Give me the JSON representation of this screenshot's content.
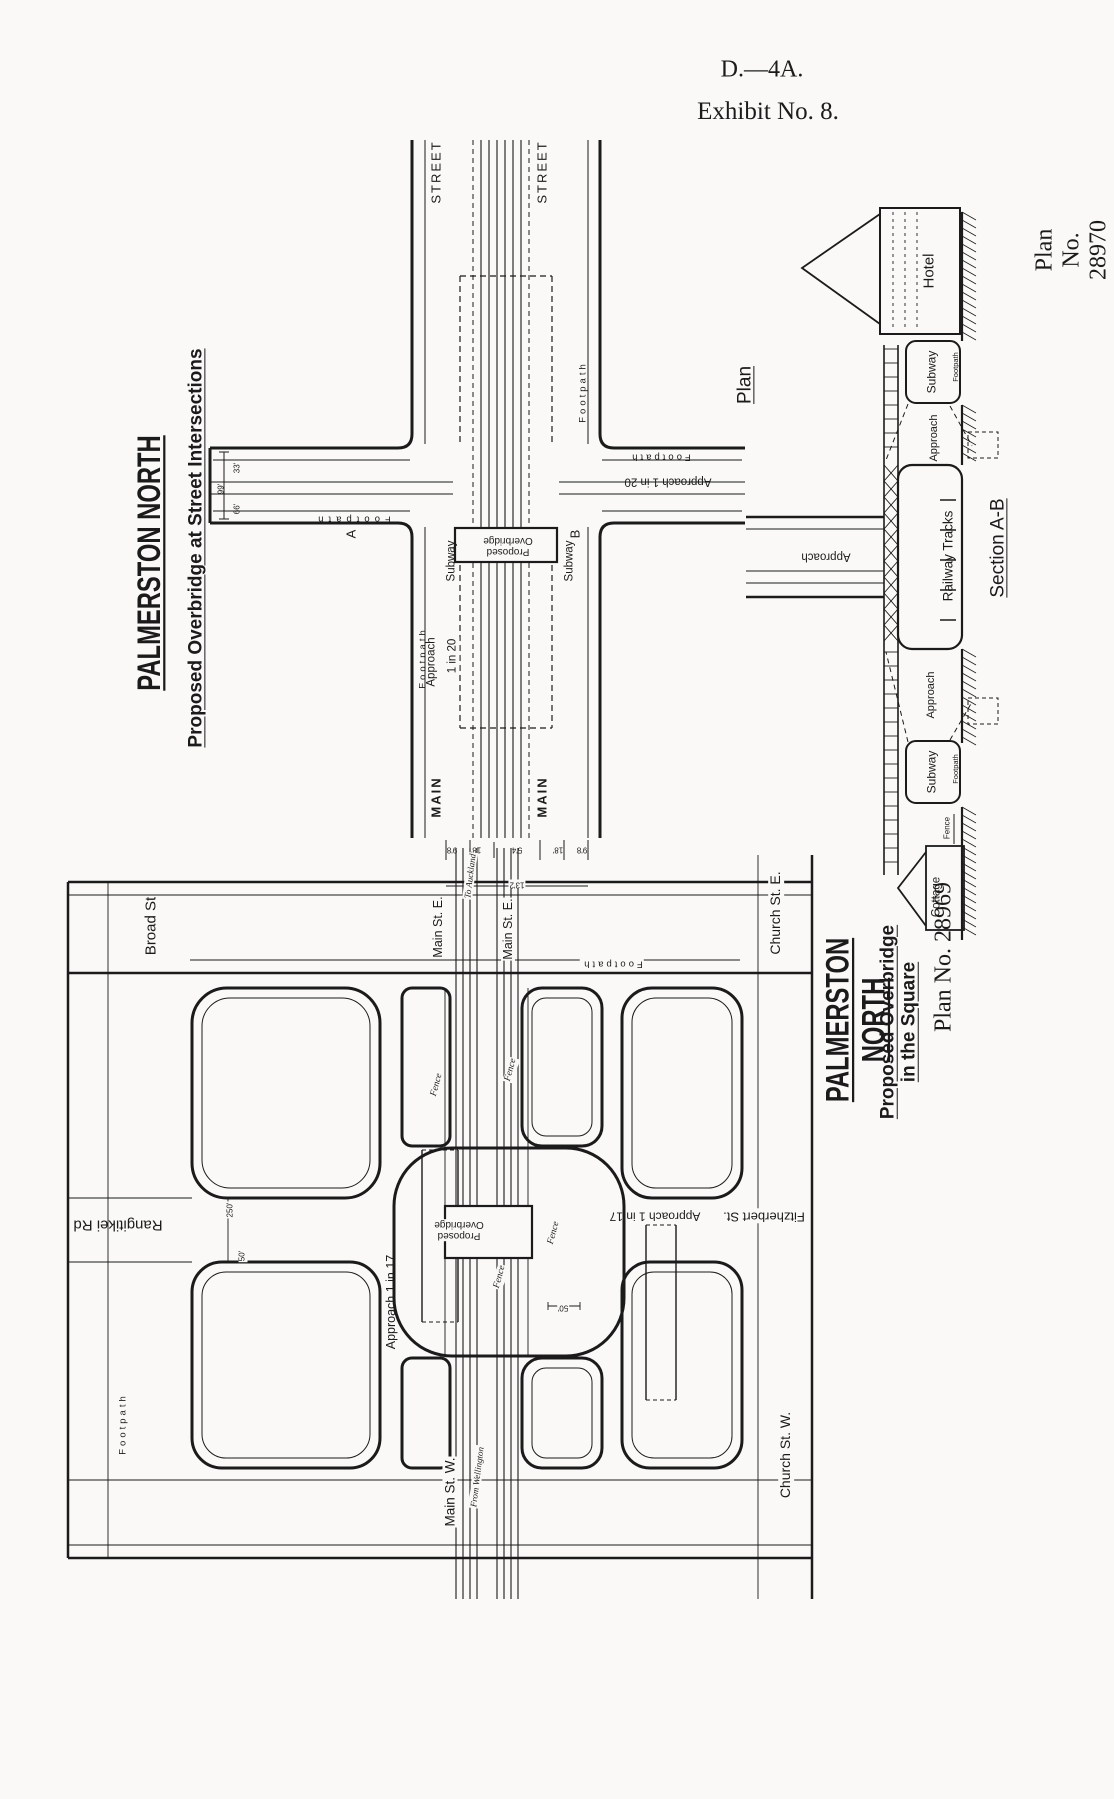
{
  "document_code": "D.—4A.",
  "exhibit": "Exhibit No. 8.",
  "ink_color": "#1b1b1b",
  "paper_color": "#faf9f7",
  "plans": [
    {
      "plan_no": "Plan No. 28970",
      "title": "PALMERSTON NORTH",
      "subtitle": "Proposed Overbridge at Street Intersections",
      "views": [
        "Plan",
        "Section A-B"
      ]
    },
    {
      "plan_no": "Plan No. 28969",
      "title": "PALMERSTON NORTH",
      "subtitle": "Proposed Overbridge in the Square"
    }
  ],
  "labels": [
    {
      "id": "hdr-d4a",
      "text": "D.—4A."
    },
    {
      "id": "hdr-exhibit",
      "text": "Exhibit No. 8."
    },
    {
      "id": "t1-plan-no",
      "text": "Plan No. 28970"
    },
    {
      "id": "t1-title",
      "text": "PALMERSTON NORTH"
    },
    {
      "id": "t1-sub",
      "text": "Proposed Overbridge at Street Intersections"
    },
    {
      "id": "plan-label",
      "text": "Plan"
    },
    {
      "id": "section-label",
      "text": "Section A-B"
    },
    {
      "id": "tp-street-left",
      "text": "STREET"
    },
    {
      "id": "tp-street-right",
      "text": "STREET"
    },
    {
      "id": "tp-main-left",
      "text": "MAIN"
    },
    {
      "id": "tp-main-right",
      "text": "MAIN"
    },
    {
      "id": "tp-footpath-right-edge",
      "text": "Footpath"
    },
    {
      "id": "tp-footpath-left-arm",
      "text": "Footpath"
    },
    {
      "id": "tp-footpath-right-arm",
      "text": "Footpath"
    },
    {
      "id": "tp-footpath-below",
      "text": "Footpath"
    },
    {
      "id": "tp-subway-left",
      "text": "Subway"
    },
    {
      "id": "tp-subway-right",
      "text": "Subway"
    },
    {
      "id": "tp-proposed-ob",
      "text": "Proposed\nOverbridge"
    },
    {
      "id": "tp-a",
      "text": "A"
    },
    {
      "id": "tp-b",
      "text": "B"
    },
    {
      "id": "tp-approach-below",
      "text": "Approach"
    },
    {
      "id": "tp-1in20-below",
      "text": "1 in 20"
    },
    {
      "id": "tp-approach-1in20-right",
      "text": "Approach    1 in 20"
    },
    {
      "id": "tp-dim-99",
      "text": "99'"
    },
    {
      "id": "tp-dim-33",
      "text": "33'"
    },
    {
      "id": "tp-dim-66",
      "text": "66'"
    },
    {
      "id": "tp-dim-9-8-a",
      "text": "9'8"
    },
    {
      "id": "tp-dim-18-a",
      "text": "18'"
    },
    {
      "id": "tp-dim-5-4",
      "text": "5'4"
    },
    {
      "id": "tp-dim-18-b",
      "text": "18'"
    },
    {
      "id": "tp-dim-9-8-b",
      "text": "9'8"
    },
    {
      "id": "tp-dim-13-2",
      "text": "13'2"
    },
    {
      "id": "sec-hotel",
      "text": "Hotel"
    },
    {
      "id": "sec-footpath-top",
      "text": "Footpath"
    },
    {
      "id": "sec-subway-top",
      "text": "Subway"
    },
    {
      "id": "sec-approach-top",
      "text": "Approach"
    },
    {
      "id": "sec-railway-tracks",
      "text": "Railway   Tracks"
    },
    {
      "id": "sec-approach-road",
      "text": "Approach"
    },
    {
      "id": "sec-approach-bottom",
      "text": "Approach"
    },
    {
      "id": "sec-subway-bottom",
      "text": "Subway"
    },
    {
      "id": "sec-footpath-bottom",
      "text": "Footpath"
    },
    {
      "id": "sec-fence",
      "text": "Fence"
    },
    {
      "id": "sec-cottage",
      "text": "Cottage"
    },
    {
      "id": "t2-plan-no",
      "text": "Plan No. 28969"
    },
    {
      "id": "t2-title",
      "text": "PALMERSTON NORTH"
    },
    {
      "id": "t2-sub",
      "text": "Proposed Overbridge in the Square"
    },
    {
      "id": "bp-broad-st",
      "text": "Broad St"
    },
    {
      "id": "bp-main-st-e-left",
      "text": "Main St. E."
    },
    {
      "id": "bp-to-auckland",
      "text": "To Auckland"
    },
    {
      "id": "bp-main-st-e-right",
      "text": "Main St. E."
    },
    {
      "id": "bp-church-st-e",
      "text": "Church St. E."
    },
    {
      "id": "bp-footpath-top",
      "text": "Footpath"
    },
    {
      "id": "bp-rangitikei",
      "text": "Rangitikei Rd"
    },
    {
      "id": "bp-dim-250",
      "text": "250'"
    },
    {
      "id": "bp-dim-50a",
      "text": "50'"
    },
    {
      "id": "bp-approach-left",
      "text": "Approach    1 in 17"
    },
    {
      "id": "bp-proposed-ob",
      "text": "Proposed\nOverbridge"
    },
    {
      "id": "bp-fence-1",
      "text": "Fence"
    },
    {
      "id": "bp-fence-2",
      "text": "Fence"
    },
    {
      "id": "bp-fence-3",
      "text": "Fence"
    },
    {
      "id": "bp-fence-4",
      "text": "Fence"
    },
    {
      "id": "bp-dim-50b",
      "text": "50'"
    },
    {
      "id": "bp-approach-right",
      "text": "Approach  1 in 17"
    },
    {
      "id": "bp-fitzherbert",
      "text": "Fitzherbert St."
    },
    {
      "id": "bp-footpath-left",
      "text": "Footpath"
    },
    {
      "id": "bp-main-st-w",
      "text": "Main St. W."
    },
    {
      "id": "bp-from-wellington",
      "text": "From Wellington"
    },
    {
      "id": "bp-church-st-w",
      "text": "Church St. W."
    }
  ]
}
